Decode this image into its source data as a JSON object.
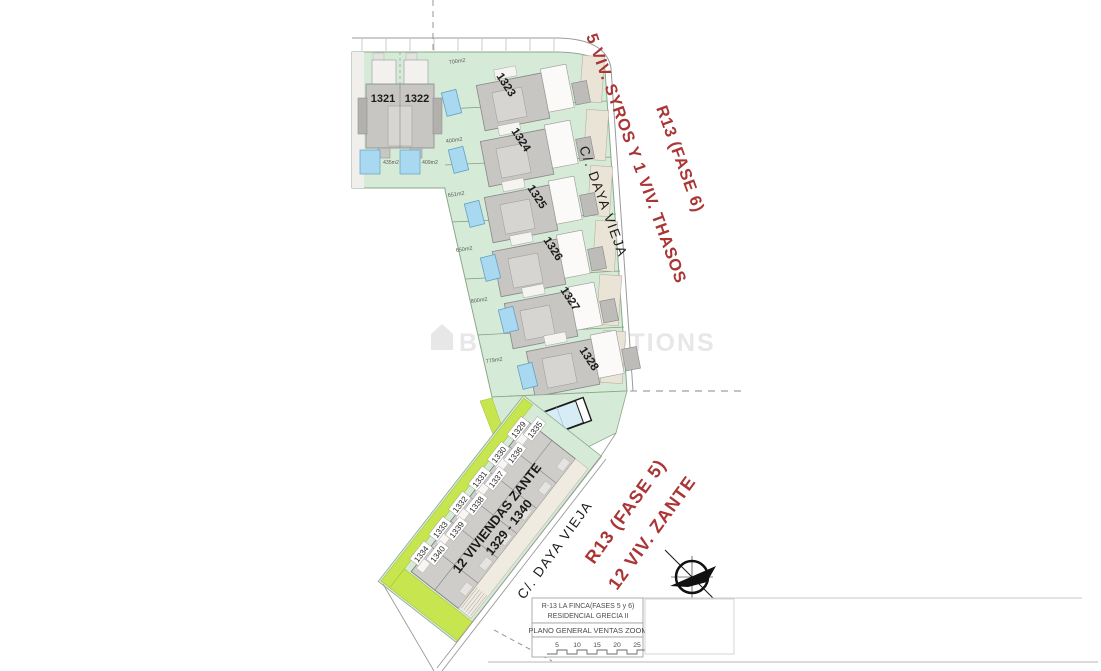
{
  "watermark": "B&L PROMOTIONS",
  "streets": {
    "upper": "C/. DAYA VIEJA",
    "lower": "C/. DAYA VIEJA"
  },
  "phase6": {
    "label_line1": "5 VIV. SYROS Y 1 VIV. THASOS",
    "label_line2": "R13 (FASE 6)",
    "duplex": {
      "left_number": "1321",
      "right_number": "1322",
      "left_area": "435m2",
      "right_area": "409m2"
    },
    "plots": [
      {
        "number": "1323",
        "area": "700m2"
      },
      {
        "number": "1324",
        "area": "400m2"
      },
      {
        "number": "1325",
        "area": "651m2"
      },
      {
        "number": "1326",
        "area": "650m2"
      },
      {
        "number": "1327",
        "area": "800m2"
      },
      {
        "number": "1328",
        "area": "779m2"
      }
    ]
  },
  "phase5": {
    "label_line1": "R13 (FASE 5)",
    "label_line2": "12 VIV. ZANTE",
    "block_title": "12 VIVIENDAS ZANTE",
    "block_range": "1329 - 1340",
    "pairs": [
      [
        "1329",
        "1335"
      ],
      [
        "1330",
        "1336"
      ],
      [
        "1331",
        "1337"
      ],
      [
        "1332",
        "1338"
      ],
      [
        "1333",
        "1339"
      ],
      [
        "1334",
        "1340"
      ]
    ]
  },
  "title_block": {
    "line1": "R-13 LA FINCA(FASES 5 y 6)",
    "line2": "RESIDENCIAL GRECIA II",
    "line3": "PLANO GENERAL VENTAS ZOOM",
    "scale_ticks": [
      "5",
      "10",
      "15",
      "20",
      "25"
    ]
  },
  "colors": {
    "plot_green": "#d6ebd7",
    "lime": "#c6e54e",
    "building_gray": "#c8c6c3",
    "pool_blue": "#a9d9f0",
    "driveway_beige": "#e9e4d6",
    "red_text": "#ab3434"
  }
}
